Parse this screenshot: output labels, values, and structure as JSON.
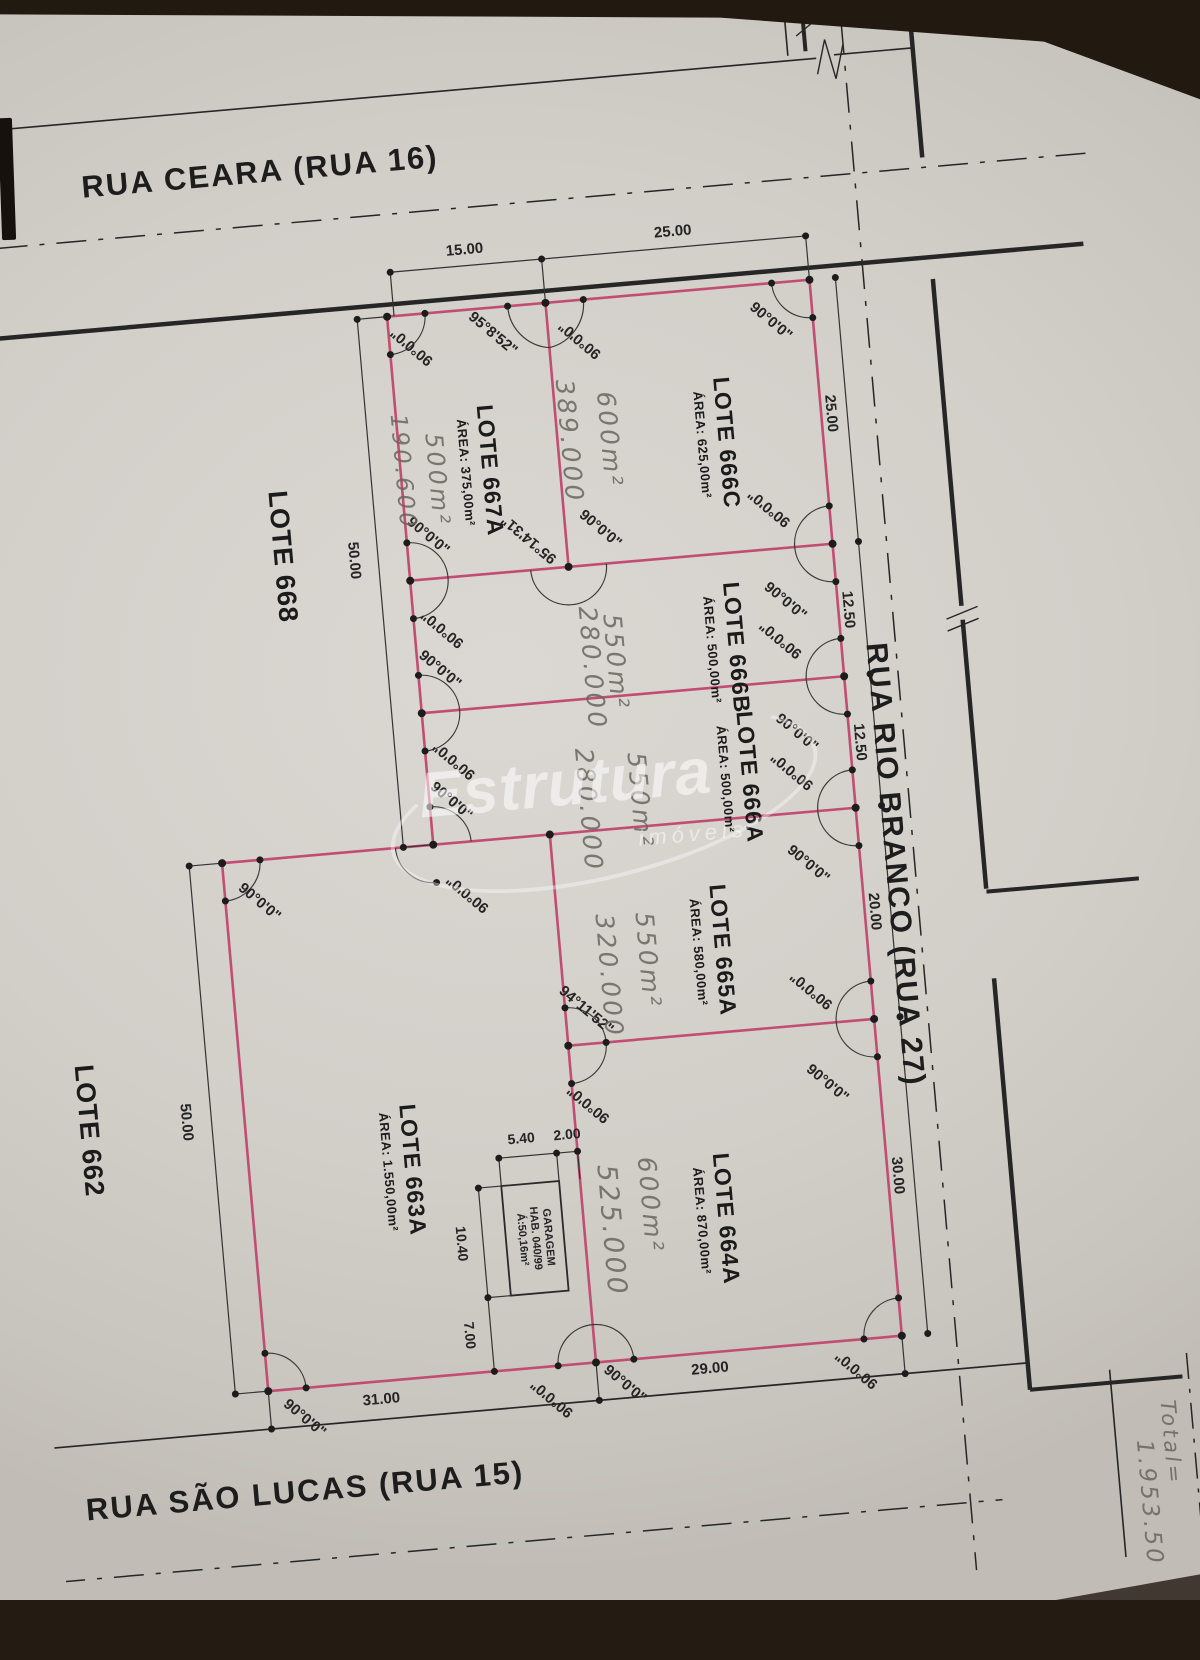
{
  "streets": {
    "top": "RUA CEARA (RUA 16)",
    "right": "RUA RIO BRANCO (RUA 27)",
    "bottom": "RUA SÃO LUCAS (RUA 15)"
  },
  "watermark": {
    "brand": "Estrutura",
    "sub": "imóveis"
  },
  "garage": {
    "line1": "GARAGEM",
    "line2": "HAB. 040/99",
    "line3": "Á:50,16m²"
  },
  "lots": [
    {
      "name": "LOTE 667A",
      "area": "ÁREA: 375,00m²",
      "x": 510,
      "y": 462,
      "size": 23
    },
    {
      "name": "LOTE 666C",
      "area": "ÁREA: 625,00m²",
      "x": 748,
      "y": 455,
      "size": 23
    },
    {
      "name": "LOTE 666B",
      "area": "ÁREA: 500,00m²",
      "x": 740,
      "y": 660,
      "size": 23
    },
    {
      "name": "LOTE 666A",
      "area": "ÁREA: 500,00m²",
      "x": 742,
      "y": 790,
      "size": 23
    },
    {
      "name": "LOTE 665A",
      "area": "ÁREA: 580,00m²",
      "x": 700,
      "y": 960,
      "size": 23
    },
    {
      "name": "LOTE 664A",
      "area": "ÁREA: 870,00m²",
      "x": 680,
      "y": 1228,
      "size": 23
    },
    {
      "name": "LOTE 663A",
      "area": "ÁREA: 1.550,00m²",
      "x": 372,
      "y": 1152,
      "size": 23
    },
    {
      "name": "LOTE 668",
      "area": "",
      "x": 305,
      "y": 530,
      "size": 27
    },
    {
      "name": "LOTE 662",
      "area": "",
      "x": 62,
      "y": 1085,
      "size": 27
    }
  ],
  "dimensions": [
    {
      "text": "15.00",
      "x": 513,
      "y": 240,
      "rot": 0,
      "size": 15
    },
    {
      "text": "25.00",
      "x": 722,
      "y": 240,
      "rot": 0,
      "size": 15
    },
    {
      "text": "25.00",
      "x": 864,
      "y": 435,
      "rot": 90,
      "size": 15
    },
    {
      "text": "12.50",
      "x": 864,
      "y": 632,
      "rot": 90,
      "size": 15
    },
    {
      "text": "12.50",
      "x": 864,
      "y": 765,
      "rot": 90,
      "size": 15
    },
    {
      "text": "20.00",
      "x": 864,
      "y": 935,
      "rot": 90,
      "size": 15
    },
    {
      "text": "30.00",
      "x": 864,
      "y": 1200,
      "rot": 90,
      "size": 15
    },
    {
      "text": "50.00",
      "x": 376,
      "y": 540,
      "rot": 90,
      "size": 15
    },
    {
      "text": "50.00",
      "x": 160,
      "y": 1085,
      "rot": 90,
      "size": 15
    },
    {
      "text": "31.00",
      "x": 330,
      "y": 1378,
      "rot": 0,
      "size": 15
    },
    {
      "text": "29.00",
      "x": 660,
      "y": 1376,
      "rot": 0,
      "size": 15
    },
    {
      "text": "5.40",
      "x": 492,
      "y": 1130,
      "rot": 0,
      "size": 14
    },
    {
      "text": "2.00",
      "x": 538,
      "y": 1130,
      "rot": 0,
      "size": 14
    },
    {
      "text": "10.40",
      "x": 424,
      "y": 1230,
      "rot": 90,
      "size": 14
    },
    {
      "text": "7.00",
      "x": 424,
      "y": 1322,
      "rot": 90,
      "size": 14
    }
  ],
  "angles": [
    {
      "text": "90°0'0\"",
      "x": 452,
      "y": 332,
      "rot": 225
    },
    {
      "text": "95°8'52\"",
      "x": 534,
      "y": 326,
      "rot": 45
    },
    {
      "text": "90°0'0\"",
      "x": 620,
      "y": 340,
      "rot": 225
    },
    {
      "text": "90°0'0\"",
      "x": 812,
      "y": 338,
      "rot": 45
    },
    {
      "text": "90°0'0\"",
      "x": 452,
      "y": 522,
      "rot": 45
    },
    {
      "text": "90°0'0\"",
      "x": 458,
      "y": 616,
      "rot": 225
    },
    {
      "text": "95°14'31\"",
      "x": 552,
      "y": 534,
      "rot": 225
    },
    {
      "text": "90°0'0\"",
      "x": 624,
      "y": 530,
      "rot": 45
    },
    {
      "text": "90°0'0\"",
      "x": 794,
      "y": 524,
      "rot": 225
    },
    {
      "text": "90°0'0\"",
      "x": 802,
      "y": 618,
      "rot": 45
    },
    {
      "text": "90°0'0\"",
      "x": 452,
      "y": 656,
      "rot": 45
    },
    {
      "text": "90°0'0\"",
      "x": 458,
      "y": 748,
      "rot": 225
    },
    {
      "text": "90°0'0\"",
      "x": 794,
      "y": 656,
      "rot": 225
    },
    {
      "text": "90°0'0\"",
      "x": 802,
      "y": 750,
      "rot": 45
    },
    {
      "text": "90°0'0\"",
      "x": 252,
      "y": 872,
      "rot": 45
    },
    {
      "text": "90°0'0\"",
      "x": 452,
      "y": 788,
      "rot": 45
    },
    {
      "text": "90°0'0\"",
      "x": 460,
      "y": 882,
      "rot": 225
    },
    {
      "text": "90°0'0\"",
      "x": 794,
      "y": 788,
      "rot": 225
    },
    {
      "text": "90°0'0\"",
      "x": 802,
      "y": 882,
      "rot": 45
    },
    {
      "text": "94°11'52\"",
      "x": 568,
      "y": 1008,
      "rot": 45
    },
    {
      "text": "90°0'0\"",
      "x": 562,
      "y": 1102,
      "rot": 225
    },
    {
      "text": "90°0'0\"",
      "x": 794,
      "y": 1008,
      "rot": 225
    },
    {
      "text": "90°0'0\"",
      "x": 802,
      "y": 1102,
      "rot": 45
    },
    {
      "text": "90°0'0\"",
      "x": 252,
      "y": 1390,
      "rot": 45
    },
    {
      "text": "90°0'0\"",
      "x": 500,
      "y": 1392,
      "rot": 225
    },
    {
      "text": "90°0'0\"",
      "x": 574,
      "y": 1384,
      "rot": 45
    },
    {
      "text": "90°0'0\"",
      "x": 806,
      "y": 1390,
      "rot": 225
    }
  ],
  "handwritten": [
    {
      "text": "500m²",
      "x": 466,
      "y": 467,
      "size": 24
    },
    {
      "text": "190.600",
      "x": 432,
      "y": 456,
      "size": 23
    },
    {
      "text": "600m²",
      "x": 641,
      "y": 442,
      "size": 25
    },
    {
      "text": "389.000",
      "x": 601,
      "y": 440,
      "size": 25
    },
    {
      "text": "550m²",
      "x": 628,
      "y": 664,
      "size": 25
    },
    {
      "text": "280.000",
      "x": 604,
      "y": 668,
      "size": 25
    },
    {
      "text": "550m²",
      "x": 640,
      "y": 804,
      "size": 25
    },
    {
      "text": "280.000",
      "x": 588,
      "y": 809,
      "size": 25
    },
    {
      "text": "550m²",
      "x": 634,
      "y": 964,
      "size": 25
    },
    {
      "text": "320.000",
      "x": 594,
      "y": 976,
      "size": 25
    },
    {
      "text": "600m²",
      "x": 615,
      "y": 1208,
      "size": 25
    },
    {
      "text": "525.000",
      "x": 574,
      "y": 1230,
      "size": 27
    },
    {
      "text": "Total=",
      "x": 1113,
      "y": 1490,
      "size": 21
    },
    {
      "text": "1.953.50",
      "x": 1086,
      "y": 1548,
      "size": 23
    }
  ]
}
